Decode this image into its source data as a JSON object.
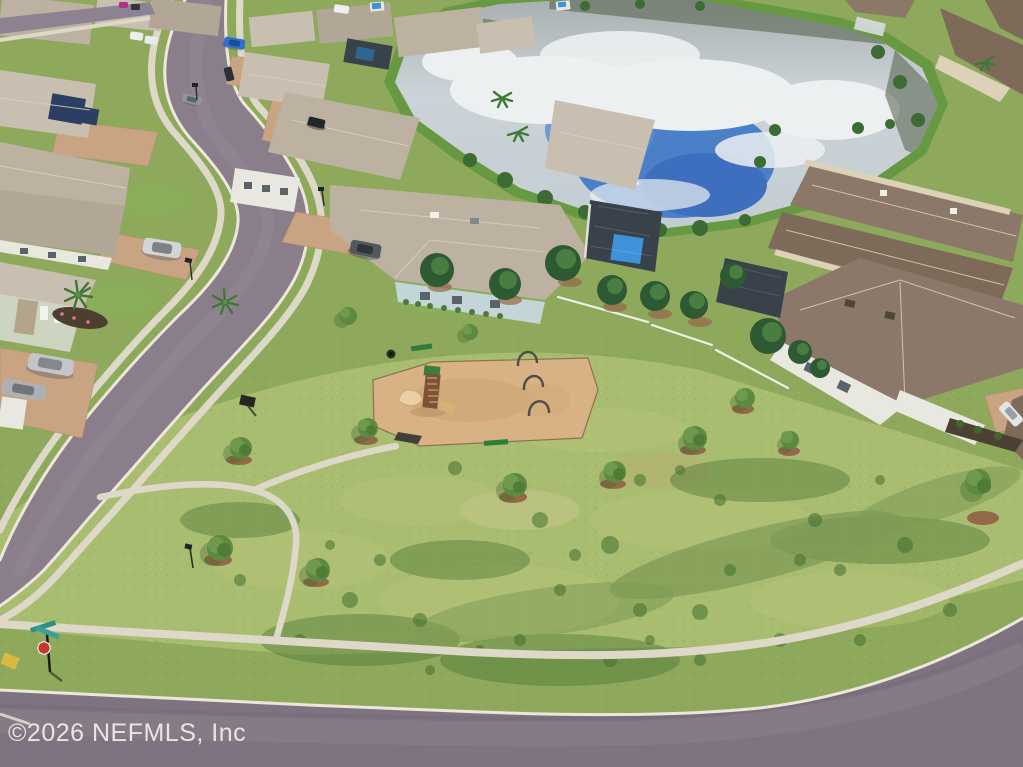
{
  "image": {
    "kind": "aerial drone photograph",
    "subject": "suburban community park with playground, curving streets, single-family homes and a retention pond",
    "width_px": 1023,
    "height_px": 767
  },
  "watermark": {
    "text": "©2026 NEFMLS, Inc",
    "color": "#f1efe8",
    "position": "bottom-left"
  },
  "scene": {
    "pond": {
      "label": "retention pond reflecting clouds and blue sky",
      "water_reflection_gray": "#c7ced3",
      "sky_blue_reflection": "#4b80c8",
      "cloud_white": "#edf0f1"
    },
    "park": {
      "label": "community green space with walking paths",
      "grass_color": "#a9bd70",
      "playground": {
        "surface": "tan playground pad",
        "surface_color": "#d8b285",
        "equipment": [
          "slide tower with twin slides",
          "three swing-frame arches",
          "north park bench",
          "south park bench",
          "trash can",
          "rubber access mat"
        ]
      },
      "young_trees_count": 12,
      "paths": "looping concrete sidewalks"
    },
    "streets": {
      "label": "S-curving asphalt street meeting a perimeter road",
      "asphalt_color": "#8a7e8b",
      "curb_color": "#ece7da",
      "sidewalk_color": "#ded8c9",
      "signage": {
        "stop_sign_color": "#c0392b",
        "street_name_blade_color": "#2f8f85",
        "corner_ramp_pad_color": "#d9b93e"
      }
    },
    "homes": {
      "left_row": "one-story homes with tan shingle roofs and paver driveways",
      "right_row": "two-story homes with brown shingle roofs",
      "details": [
        "rooftop solar array",
        "screened pool enclosures",
        "backyard swimming pool",
        "white privacy fencing"
      ]
    },
    "vehicles": {
      "count_visible": 14,
      "colors": [
        "blue",
        "white",
        "silver",
        "gray",
        "black",
        "magenta"
      ]
    }
  },
  "palette": {
    "grass_base": "#8fa95c",
    "park_grass": "#a9bd70",
    "asphalt": "#8a7e8b",
    "asphalt_perimeter": "#7e7380",
    "sidewalk": "#ded8c9",
    "paver_driveway": "#c8a482",
    "roof_tan": "#bdb2a2",
    "roof_brown": "#7e6a59",
    "pool_blue": "#3e93d8",
    "pine_green": "#2e5a33",
    "mulch_brown": "#96684a",
    "playground_pad": "#d8b285"
  }
}
